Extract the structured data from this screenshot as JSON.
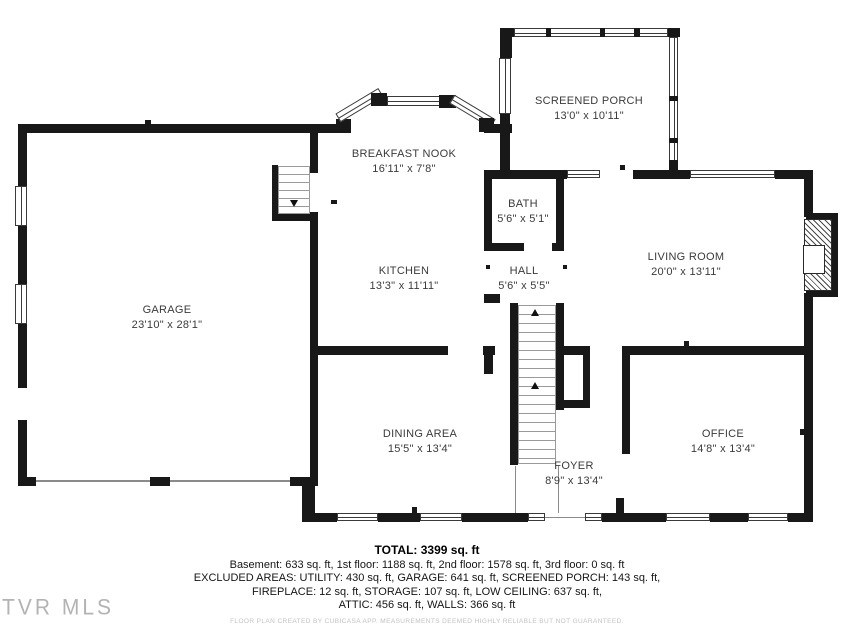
{
  "rooms": {
    "screened_porch": {
      "name": "SCREENED PORCH",
      "dims": "13'0\" x 10'11\""
    },
    "breakfast_nook": {
      "name": "BREAKFAST NOOK",
      "dims": "16'11\" x 7'8\""
    },
    "bath": {
      "name": "BATH",
      "dims": "5'6\" x 5'1\""
    },
    "living_room": {
      "name": "LIVING ROOM",
      "dims": "20'0\" x 13'11\""
    },
    "kitchen": {
      "name": "KITCHEN",
      "dims": "13'3\" x 11'11\""
    },
    "hall": {
      "name": "HALL",
      "dims": "5'6\" x 5'5\""
    },
    "garage": {
      "name": "GARAGE",
      "dims": "23'10\" x 28'1\""
    },
    "dining_area": {
      "name": "DINING AREA",
      "dims": "15'5\" x 13'4\""
    },
    "foyer": {
      "name": "FOYER",
      "dims": "8'9\" x 13'4\""
    },
    "office": {
      "name": "OFFICE",
      "dims": "14'8\" x 13'4\""
    }
  },
  "summary": {
    "total": "TOTAL: 3399 sq. ft",
    "line1": "Basement: 633 sq. ft, 1st floor: 1188 sq. ft, 2nd floor: 1578 sq. ft, 3rd floor: 0 sq. ft",
    "line2": "EXCLUDED AREAS: UTILITY: 430 sq. ft, GARAGE: 641 sq. ft, SCREENED PORCH: 143 sq. ft,",
    "line3": "FIREPLACE: 12 sq. ft, STORAGE: 107 sq. ft, LOW CEILING: 637 sq. ft,",
    "line4": "ATTIC: 456 sq. ft, WALLS: 366 sq. ft"
  },
  "watermark": "TVR MLS",
  "disclaimer": "FLOOR PLAN CREATED BY CUBICASA APP. MEASUREMENTS DEEMED HIGHLY RELIABLE BUT NOT GUARANTEED.",
  "colors": {
    "wall": "#181818",
    "text": "#3b3b3b",
    "watermark": "#b3b3b3"
  }
}
